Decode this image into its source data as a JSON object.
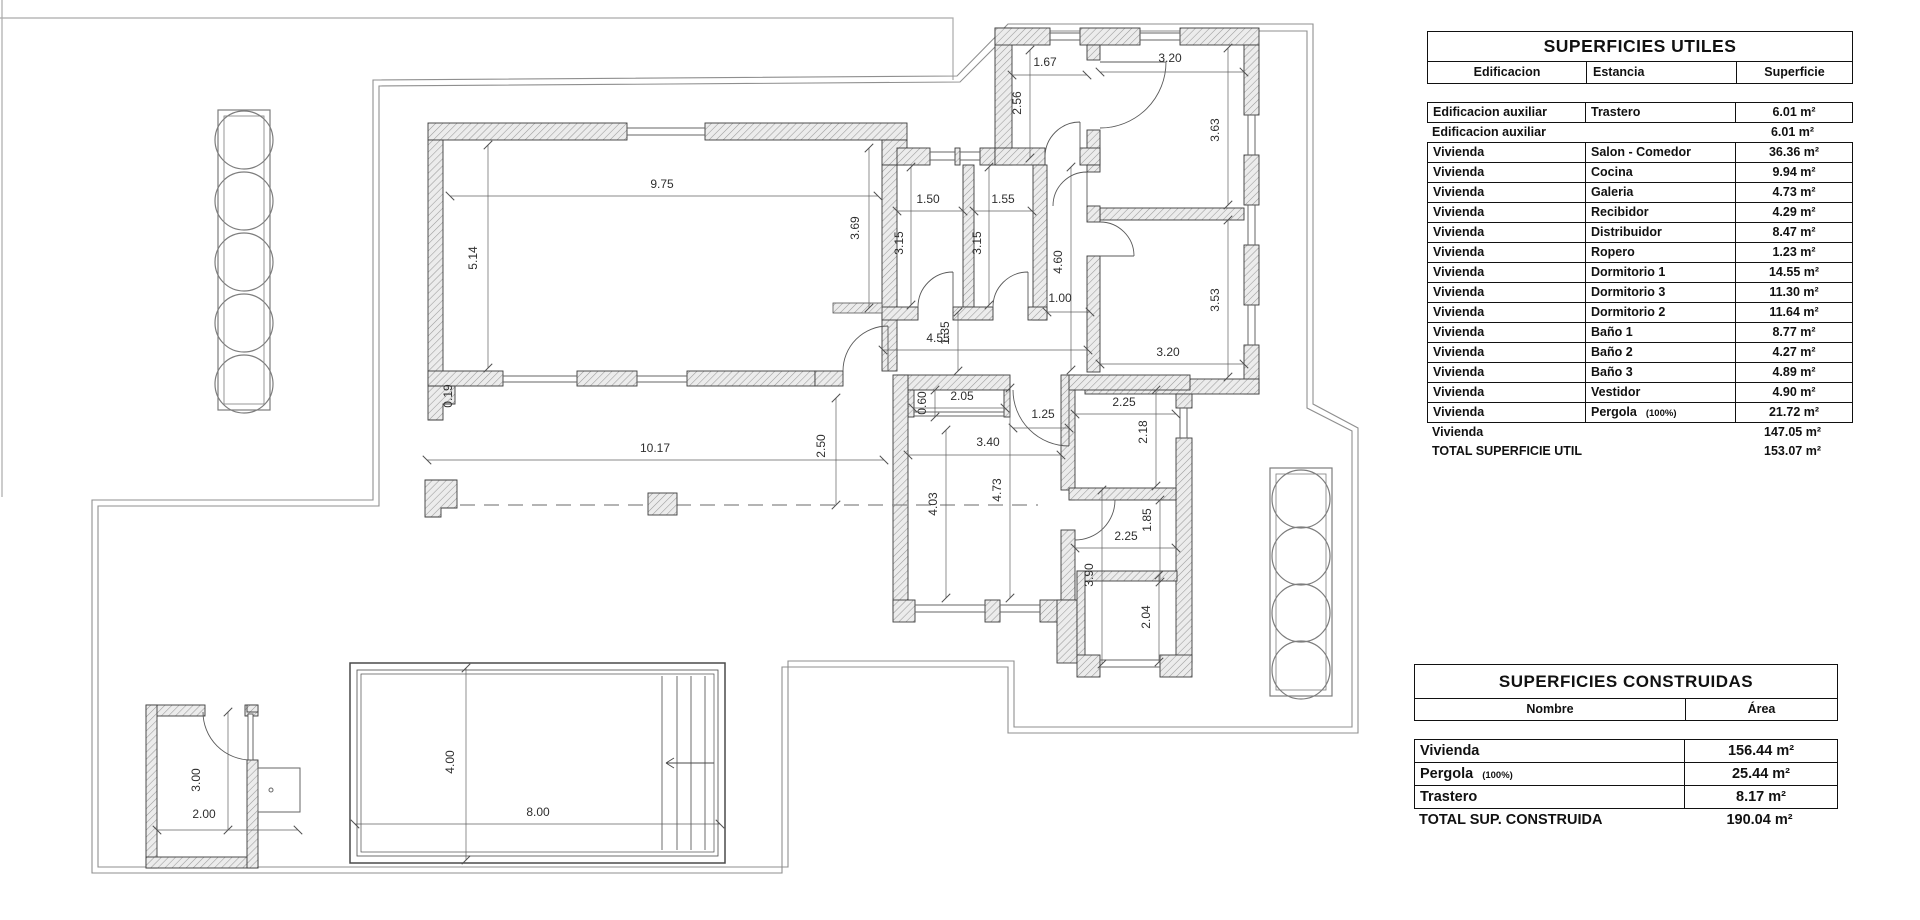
{
  "tables": {
    "utiles": {
      "title": "SUPERFICIES UTILES",
      "headers": [
        "Edificacion",
        "Estancia",
        "Superficie"
      ],
      "rows": [
        {
          "c1": "Edificacion auxiliar",
          "c2": "Trastero",
          "note": "",
          "val": "6.01 m²",
          "boxed": true
        },
        {
          "c1": "Edificacion auxiliar",
          "c2": "",
          "note": "",
          "val": "6.01 m²",
          "boxed": false
        },
        {
          "c1": "Vivienda",
          "c2": "Salon - Comedor",
          "note": "",
          "val": "36.36 m²",
          "boxed": true
        },
        {
          "c1": "Vivienda",
          "c2": "Cocina",
          "note": "",
          "val": "9.94 m²",
          "boxed": true
        },
        {
          "c1": "Vivienda",
          "c2": "Galeria",
          "note": "",
          "val": "4.73 m²",
          "boxed": true
        },
        {
          "c1": "Vivienda",
          "c2": "Recibidor",
          "note": "",
          "val": "4.29 m²",
          "boxed": true
        },
        {
          "c1": "Vivienda",
          "c2": "Distribuidor",
          "note": "",
          "val": "8.47 m²",
          "boxed": true
        },
        {
          "c1": "Vivienda",
          "c2": "Ropero",
          "note": "",
          "val": "1.23 m²",
          "boxed": true
        },
        {
          "c1": "Vivienda",
          "c2": "Dormitorio 1",
          "note": "",
          "val": "14.55 m²",
          "boxed": true
        },
        {
          "c1": "Vivienda",
          "c2": "Dormitorio 3",
          "note": "",
          "val": "11.30 m²",
          "boxed": true
        },
        {
          "c1": "Vivienda",
          "c2": "Dormitorio 2",
          "note": "",
          "val": "11.64 m²",
          "boxed": true
        },
        {
          "c1": "Vivienda",
          "c2": "Baño 1",
          "note": "",
          "val": "8.77 m²",
          "boxed": true
        },
        {
          "c1": "Vivienda",
          "c2": "Baño 2",
          "note": "",
          "val": "4.27 m²",
          "boxed": true
        },
        {
          "c1": "Vivienda",
          "c2": "Baño 3",
          "note": "",
          "val": "4.89 m²",
          "boxed": true
        },
        {
          "c1": "Vivienda",
          "c2": "Vestidor",
          "note": "",
          "val": "4.90 m²",
          "boxed": true
        },
        {
          "c1": "Vivienda",
          "c2": "Pergola",
          "note": "(100%)",
          "val": "21.72 m²",
          "boxed": true
        },
        {
          "c1": "Vivienda",
          "c2": "",
          "note": "",
          "val": "147.05 m²",
          "boxed": false
        },
        {
          "c1": "TOTAL SUPERFICIE UTIL",
          "c2": "",
          "note": "",
          "val": "153.07 m²",
          "boxed": false
        }
      ]
    },
    "construidas": {
      "title": "SUPERFICIES CONSTRUIDAS",
      "headers": [
        "Nombre",
        "Área"
      ],
      "rows": [
        {
          "c1": "Vivienda",
          "note": "",
          "val": "156.44 m²",
          "boxed": true
        },
        {
          "c1": "Pergola",
          "note": "(100%)",
          "val": "25.44 m²",
          "boxed": true
        },
        {
          "c1": "Trastero",
          "note": "",
          "val": "8.17 m²",
          "boxed": true
        },
        {
          "c1": "TOTAL SUP. CONSTRUIDA",
          "note": "",
          "val": "190.04 m²",
          "boxed": false
        }
      ]
    }
  },
  "plan": {
    "dimensions": [
      {
        "v": "1.67",
        "x": 1045,
        "y": 66,
        "r": 0,
        "l": [
          1012,
          75,
          1087,
          75
        ]
      },
      {
        "v": "2.56",
        "x": 1021,
        "y": 103,
        "r": -90,
        "l": [
          1030,
          50,
          1030,
          158
        ]
      },
      {
        "v": "3.20",
        "x": 1170,
        "y": 62,
        "r": 0,
        "l": [
          1100,
          72,
          1244,
          72
        ]
      },
      {
        "v": "3.63",
        "x": 1219,
        "y": 130,
        "r": -90,
        "l": [
          1228,
          48,
          1228,
          205
        ]
      },
      {
        "v": "9.75",
        "x": 662,
        "y": 188,
        "r": 0,
        "l": [
          450,
          196,
          878,
          196
        ]
      },
      {
        "v": "5.14",
        "x": 477,
        "y": 258,
        "r": -90,
        "l": [
          488,
          145,
          488,
          368
        ]
      },
      {
        "v": "0.19",
        "x": 452,
        "y": 396,
        "r": -90
      },
      {
        "v": "1.50",
        "x": 928,
        "y": 203,
        "r": 0,
        "l": [
          897,
          211,
          963,
          211
        ]
      },
      {
        "v": "1.55",
        "x": 1003,
        "y": 203,
        "r": 0,
        "l": [
          974,
          211,
          1032,
          211
        ]
      },
      {
        "v": "3.69",
        "x": 859,
        "y": 228,
        "r": -90,
        "l": [
          869,
          148,
          869,
          308
        ]
      },
      {
        "v": "3.15",
        "x": 903,
        "y": 243,
        "r": -90,
        "l": [
          911,
          167,
          911,
          305
        ]
      },
      {
        "v": "3.15",
        "x": 981,
        "y": 243,
        "r": -90,
        "l": [
          989,
          167,
          989,
          305
        ]
      },
      {
        "v": "4.60",
        "x": 1062,
        "y": 262,
        "r": -90,
        "l": [
          1071,
          167,
          1071,
          370
        ]
      },
      {
        "v": "1.00",
        "x": 1060,
        "y": 302,
        "r": 0,
        "l": [
          1047,
          312,
          1090,
          312
        ]
      },
      {
        "v": "3.53",
        "x": 1219,
        "y": 300,
        "r": -90,
        "l": [
          1228,
          220,
          1228,
          377
        ]
      },
      {
        "v": "3.20",
        "x": 1168,
        "y": 356,
        "r": 0,
        "l": [
          1100,
          364,
          1244,
          364
        ]
      },
      {
        "v": "4.55",
        "x": 938,
        "y": 342,
        "r": 0,
        "l": [
          883,
          350,
          1088,
          350
        ]
      },
      {
        "v": "1.35",
        "x": 949,
        "y": 333,
        "r": -90,
        "l": [
          958,
          312,
          958,
          371
        ]
      },
      {
        "v": "10.17",
        "x": 655,
        "y": 452,
        "r": 0,
        "l": [
          427,
          460,
          884,
          460
        ]
      },
      {
        "v": "2.50",
        "x": 825,
        "y": 446,
        "r": -90,
        "l": [
          836,
          398,
          836,
          505
        ]
      },
      {
        "v": "0.60",
        "x": 926,
        "y": 403,
        "r": -90,
        "l": [
          935,
          390,
          935,
          417
        ]
      },
      {
        "v": "2.05",
        "x": 962,
        "y": 400,
        "r": 0,
        "l": [
          913,
          408,
          1005,
          408
        ]
      },
      {
        "v": "1.25",
        "x": 1043,
        "y": 418,
        "r": 0,
        "l": [
          1013,
          428,
          1069,
          428
        ]
      },
      {
        "v": "2.25",
        "x": 1124,
        "y": 406,
        "r": 0,
        "l": [
          1075,
          414,
          1176,
          414
        ]
      },
      {
        "v": "2.18",
        "x": 1147,
        "y": 432,
        "r": -90,
        "l": [
          1156,
          390,
          1156,
          486
        ]
      },
      {
        "v": "3.40",
        "x": 988,
        "y": 446,
        "r": 0,
        "l": [
          908,
          455,
          1061,
          455
        ]
      },
      {
        "v": "4.03",
        "x": 937,
        "y": 504,
        "r": -90,
        "l": [
          946,
          430,
          946,
          598
        ]
      },
      {
        "v": "4.73",
        "x": 1001,
        "y": 490,
        "r": -90,
        "l": [
          1010,
          388,
          1010,
          598
        ]
      },
      {
        "v": "2.25",
        "x": 1126,
        "y": 540,
        "r": 0,
        "l": [
          1075,
          548,
          1176,
          548
        ]
      },
      {
        "v": "1.85",
        "x": 1151,
        "y": 520,
        "r": -90,
        "l": [
          1160,
          500,
          1160,
          582
        ]
      },
      {
        "v": "3.90",
        "x": 1093,
        "y": 575,
        "r": -90,
        "l": [
          1102,
          490,
          1102,
          664
        ]
      },
      {
        "v": "2.04",
        "x": 1150,
        "y": 617,
        "r": -90,
        "l": [
          1159,
          575,
          1159,
          662
        ]
      },
      {
        "v": "4.00",
        "x": 454,
        "y": 762,
        "r": -90,
        "l": [
          466,
          668,
          466,
          860
        ]
      },
      {
        "v": "8.00",
        "x": 538,
        "y": 816,
        "r": 0,
        "l": [
          355,
          824,
          720,
          824
        ]
      },
      {
        "v": "3.00",
        "x": 200,
        "y": 780,
        "r": -90,
        "l": [
          228,
          712,
          228,
          830
        ]
      },
      {
        "v": "2.00",
        "x": 204,
        "y": 818,
        "r": 0,
        "l": [
          157,
          830,
          298,
          830
        ]
      }
    ]
  }
}
